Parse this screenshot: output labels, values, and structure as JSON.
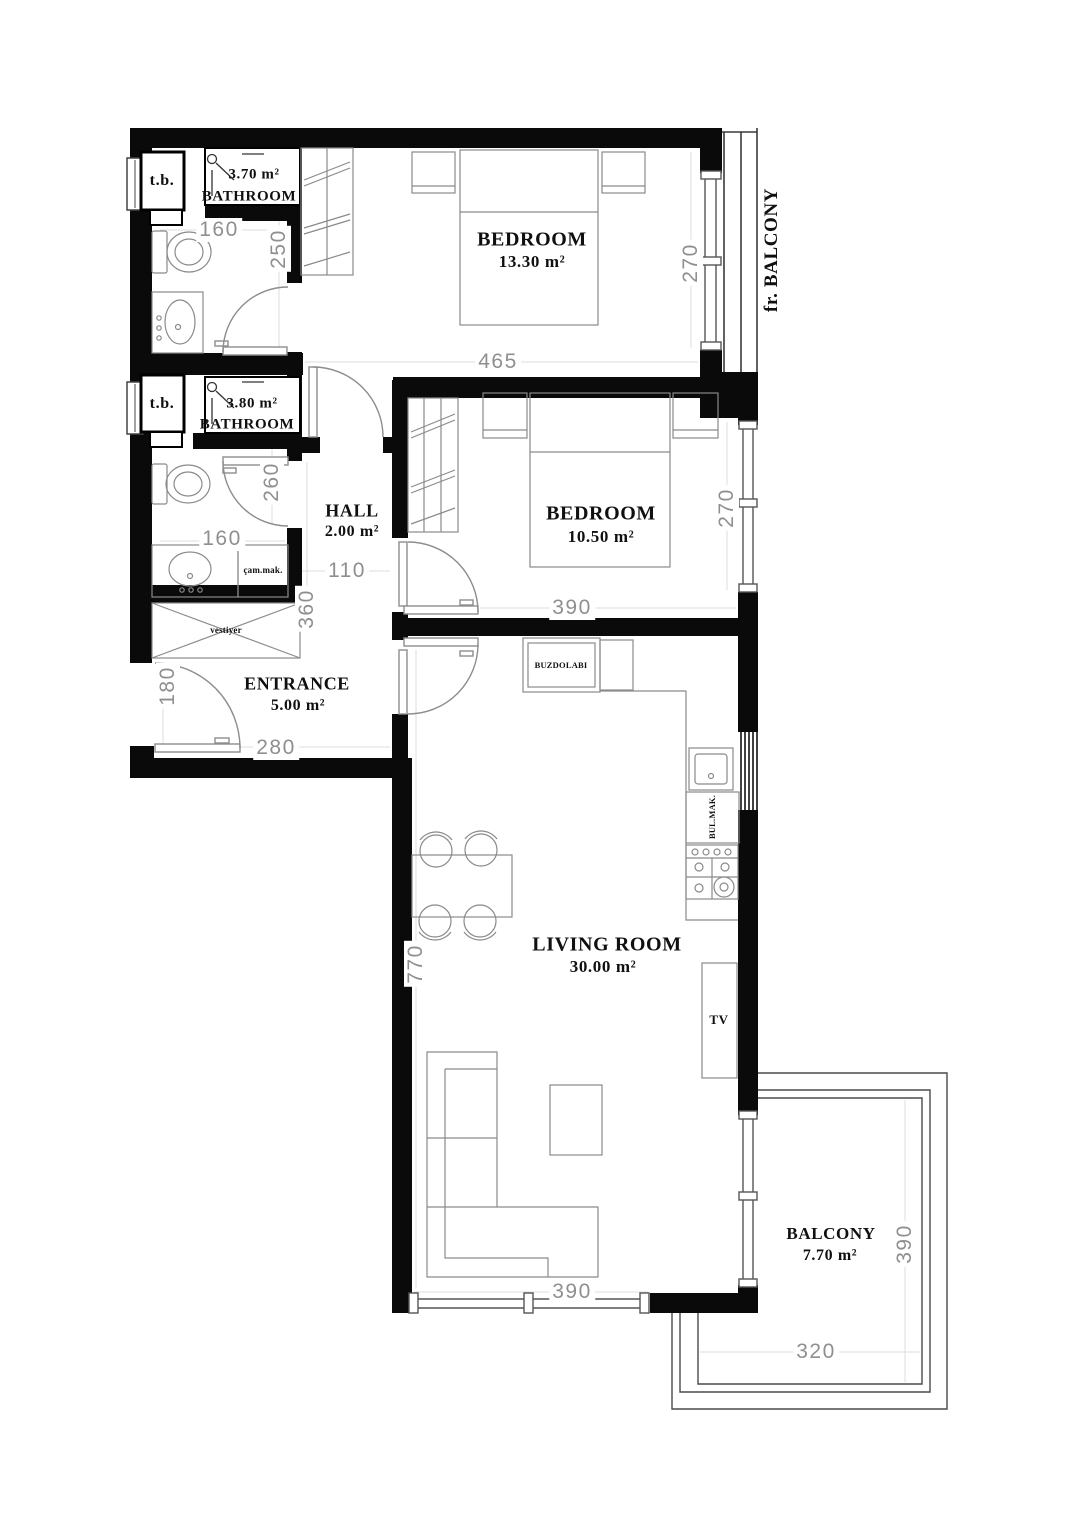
{
  "plan": {
    "title": "Apartment floor plan",
    "rooms": {
      "bathroom1": {
        "area": "3.70 m²",
        "name": "BATHROOM"
      },
      "bathroom2": {
        "area": "3.80 m²",
        "name": "BATHROOM"
      },
      "bedroom1": {
        "name": "BEDROOM",
        "area": "13.30 m²"
      },
      "bedroom2": {
        "name": "BEDROOM",
        "area": "10.50 m²"
      },
      "hall": {
        "name": "HALL",
        "area": "2.00 m²"
      },
      "entrance": {
        "name": "ENTRANCE",
        "area": "5.00 m²"
      },
      "living_room": {
        "name": "LIVING ROOM",
        "area": "30.00 m²"
      },
      "balcony": {
        "name": "BALCONY",
        "area": "7.70 m²"
      },
      "french_balcony": {
        "name": "fr. BALCONY"
      }
    },
    "fixtures": {
      "tb1": "t.b.",
      "tb2": "t.b.",
      "vestiyer": "vestiyer",
      "washing_machine": "çam.mak.",
      "fridge": "BUZDOLABI",
      "dishwasher": "BUL.MAK.",
      "tv": "TV"
    },
    "dimensions": {
      "bathroom1_width": "160",
      "bathroom1_height": "250",
      "bathroom2_width": "160",
      "bathroom2_height": "260",
      "bedroom1_width": "465",
      "bedroom1_height": "270",
      "bedroom2_width": "390",
      "bedroom2_height": "270",
      "hall_width": "110",
      "hall_height": "360",
      "entrance_height": "180",
      "entrance_width": "280",
      "living_height": "770",
      "living_width": "390",
      "balcony_height": "390",
      "balcony_width": "320"
    },
    "colors": {
      "wall": "#0a0a0a",
      "dimension_text": "#8f8f8f",
      "furniture_line": "#8a8a8a"
    }
  }
}
